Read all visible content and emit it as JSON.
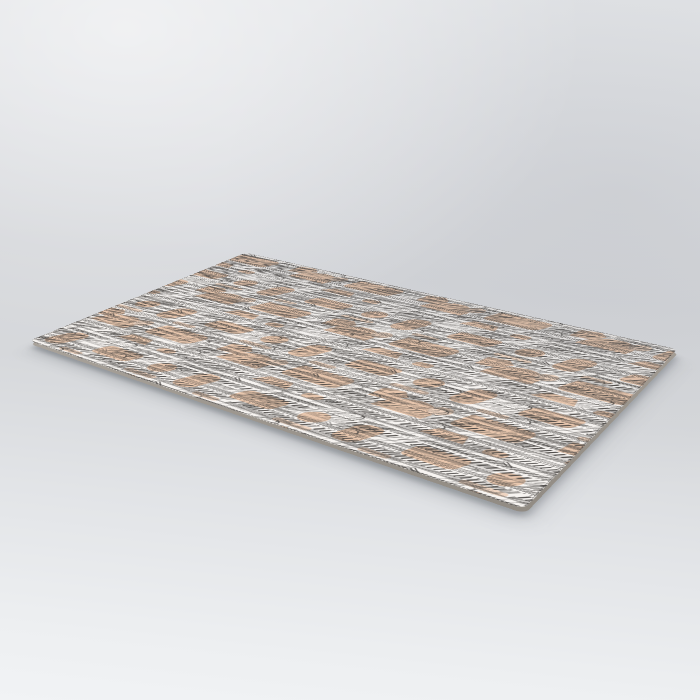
{
  "scene": {
    "kind": "studio product photo",
    "subject": "rectangular flat rug displayed at an angle, lying on a seamless pale-grey studio floor",
    "artwork": "Paris toile pattern: dense black pen-and-ink rows of Parisian architecture (Haussmann facades, Arc de Triomphe arches, domes, Eiffel Tower, rooftops, colonnades, awnings) accented with blush-peach colour patches on an off-white ground",
    "visible_text": "none"
  },
  "colors": {
    "backdrop_top_left": "#e9ebed",
    "backdrop_mid": "#d4d6d9",
    "backdrop_bottom": "#f1f3f5",
    "rug_base": "#fbf8f4",
    "peach": "#eac6aa",
    "peach_light": "#f1d6c0",
    "ink": "#3a3733",
    "gray_cast": "#c3c8cf",
    "rug_edge_light": "#b8b2ab",
    "rug_edge_dark": "#918b83",
    "shadow": "rgba(44,49,60,0.30)"
  }
}
